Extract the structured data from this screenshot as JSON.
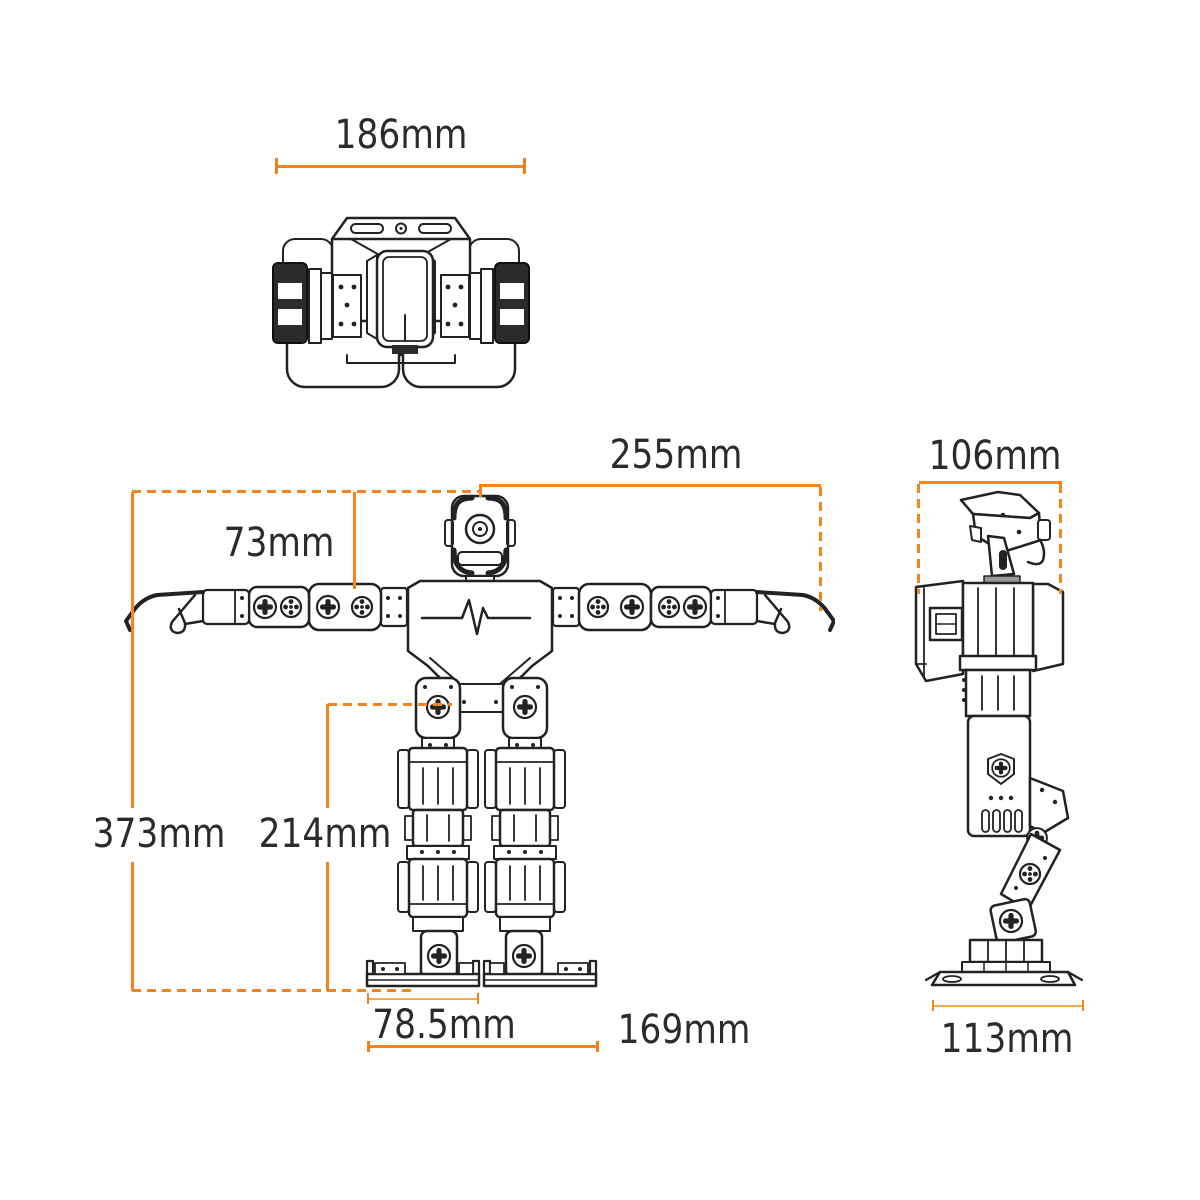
{
  "colors": {
    "dimension_accent": "#F5841C",
    "dimension_light": "#F9A94B",
    "line_art": "#222222",
    "label_text": "#2B2B2B",
    "background": "#FFFFFF"
  },
  "views": {
    "top": {
      "dims": {
        "body_width": "186mm"
      }
    },
    "front": {
      "dims": {
        "arm_span": "255mm",
        "head_to_shoulder": "73mm",
        "total_height": "373mm",
        "leg_height": "214mm",
        "foot_length": "78.5mm",
        "stance_width": "169mm"
      }
    },
    "side": {
      "dims": {
        "body_depth": "106mm",
        "foot_base": "113mm"
      }
    }
  }
}
